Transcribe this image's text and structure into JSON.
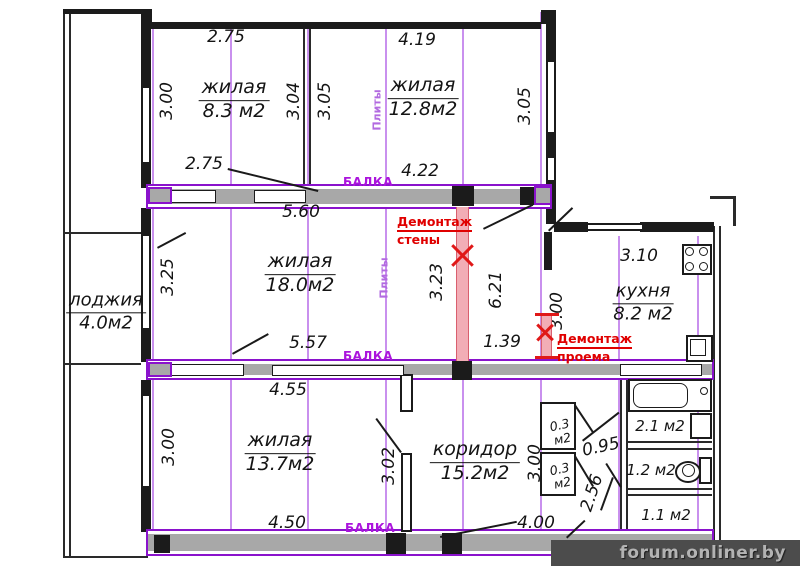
{
  "watermark": "forum.onliner.by",
  "colors": {
    "beam_outline": "#8a12cc",
    "seam_line": "#c990ee",
    "beam_fill": "#a8a8a8",
    "demolition_red": "#e01818",
    "demolition_pink": "#f2adb6",
    "wall": "#1b1b1b"
  },
  "labels": {
    "balka1": "БАЛКА",
    "balka2": "БАЛКА",
    "balka3": "БАЛКА",
    "plity1": "Плиты",
    "plity2": "Плиты",
    "demo_wall_1": "Демонтаж",
    "demo_wall_2": "стены",
    "demo_open_1": "Демонтаж",
    "demo_open_2": "проема"
  },
  "rooms": {
    "living_83": {
      "name": "жилая",
      "area": "8.3 м2"
    },
    "living_128": {
      "name": "жилая",
      "area": "12.8м2"
    },
    "living_180": {
      "name": "жилая",
      "area": "18.0м2"
    },
    "living_137": {
      "name": "жилая",
      "area": "13.7м2"
    },
    "loggia": {
      "name": "лоджия",
      "area": "4.0м2"
    },
    "kitchen": {
      "name": "кухня",
      "area": "8.2 м2"
    },
    "corridor": {
      "name": "коридор",
      "area": "15.2м2"
    },
    "closet_top": {
      "l1": "0.3",
      "l2": "м2"
    },
    "closet_bottom": {
      "l1": "0.3",
      "l2": "м2"
    },
    "bath": {
      "area": "2.1 м2"
    },
    "wc": {
      "area": "1.2 м2"
    },
    "storage": {
      "area": "1.1 м2"
    }
  },
  "dims": {
    "d275_top": "2.75",
    "d419": "4.19",
    "d300_tl": "3.00",
    "d304": "3.04",
    "d305_a": "3.05",
    "d305_b": "3.05",
    "d275_bot": "2.75",
    "d422": "4.22",
    "d560": "5.60",
    "d325": "3.25",
    "d323": "3.23",
    "d621": "6.21",
    "d139": "1.39",
    "d310": "3.10",
    "d300_k": "3.00",
    "d557": "5.57",
    "d455": "4.55",
    "d300_bl": "3.00",
    "d302": "3.02",
    "d300_c": "3.00",
    "d095": "0.95",
    "d256": "2.56",
    "d450": "4.50",
    "d400": "4.00"
  }
}
